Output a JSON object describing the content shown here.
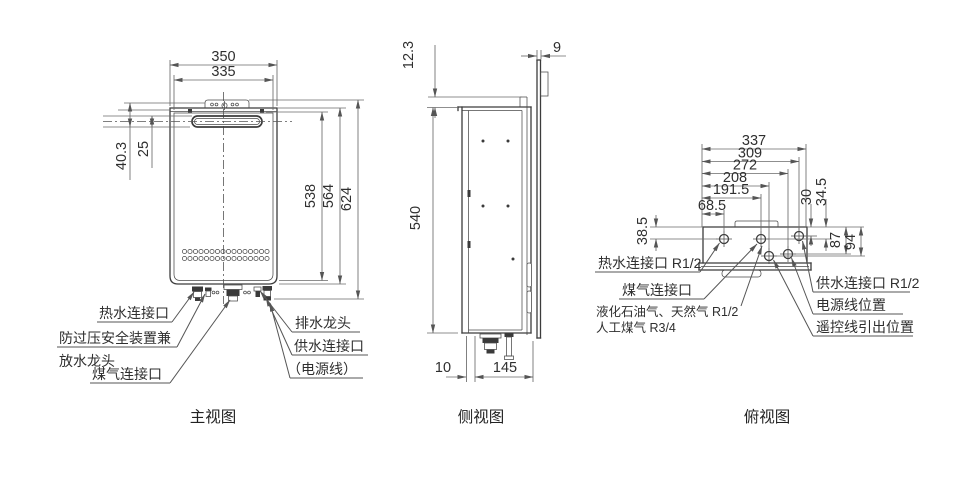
{
  "front_view": {
    "caption": "主视图",
    "dim_width_outer": "350",
    "dim_width_inner": "335",
    "dim_top_offset": "40.3",
    "dim_vent_offset": "25",
    "dim_height_inner": "538",
    "dim_height_body": "564",
    "dim_height_total": "624",
    "label_hot_water": "热水连接口",
    "label_safety_line1": "防过压安全装置兼",
    "label_safety_line2": "放水龙头",
    "label_gas": "煤气连接口",
    "label_drain": "排水龙头",
    "label_supply": "供水连接口",
    "label_power_cord": "（电源线）"
  },
  "side_view": {
    "caption": "侧视图",
    "dim_top_lip": "12.3",
    "dim_plate_thickness": "9",
    "dim_height": "540",
    "dim_front_gap": "10",
    "dim_depth": "145"
  },
  "top_view": {
    "caption": "俯视图",
    "dim_total_width": "337",
    "dim_supply": "309",
    "dim_power": "272",
    "dim_remote": "208",
    "dim_gas": "191.5",
    "dim_hot": "68.5",
    "dim_hot_depth": "38.5",
    "dim_supply_depth": "30",
    "dim_gas_depth": "34.5",
    "dim_power_depth": "87",
    "dim_remote_depth": "94",
    "label_hot_water": "热水连接口 R1/2",
    "label_gas": "煤气连接口",
    "label_gas_note_line1": "液化石油气、天然气 R1/2",
    "label_gas_note_line2": "人工煤气 R3/4",
    "label_supply": "供水连接口 R1/2",
    "label_power": "电源线位置",
    "label_remote": "遥控线引出位置"
  }
}
